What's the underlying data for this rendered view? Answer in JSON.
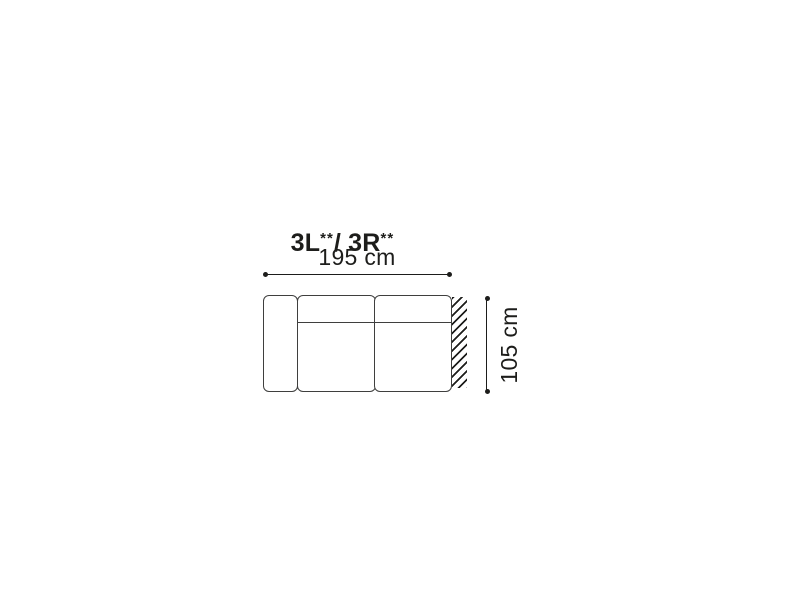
{
  "diagram": {
    "title": {
      "left_code": "3L",
      "left_sup": "**",
      "separator": "/ ",
      "right_code": "3R",
      "right_sup": "**"
    },
    "dimensions": {
      "width": "195 cm",
      "depth": "105 cm"
    },
    "colors": {
      "outline": "#3f3f3e",
      "dimension": "#1d1d1b",
      "background": "#ffffff"
    }
  }
}
